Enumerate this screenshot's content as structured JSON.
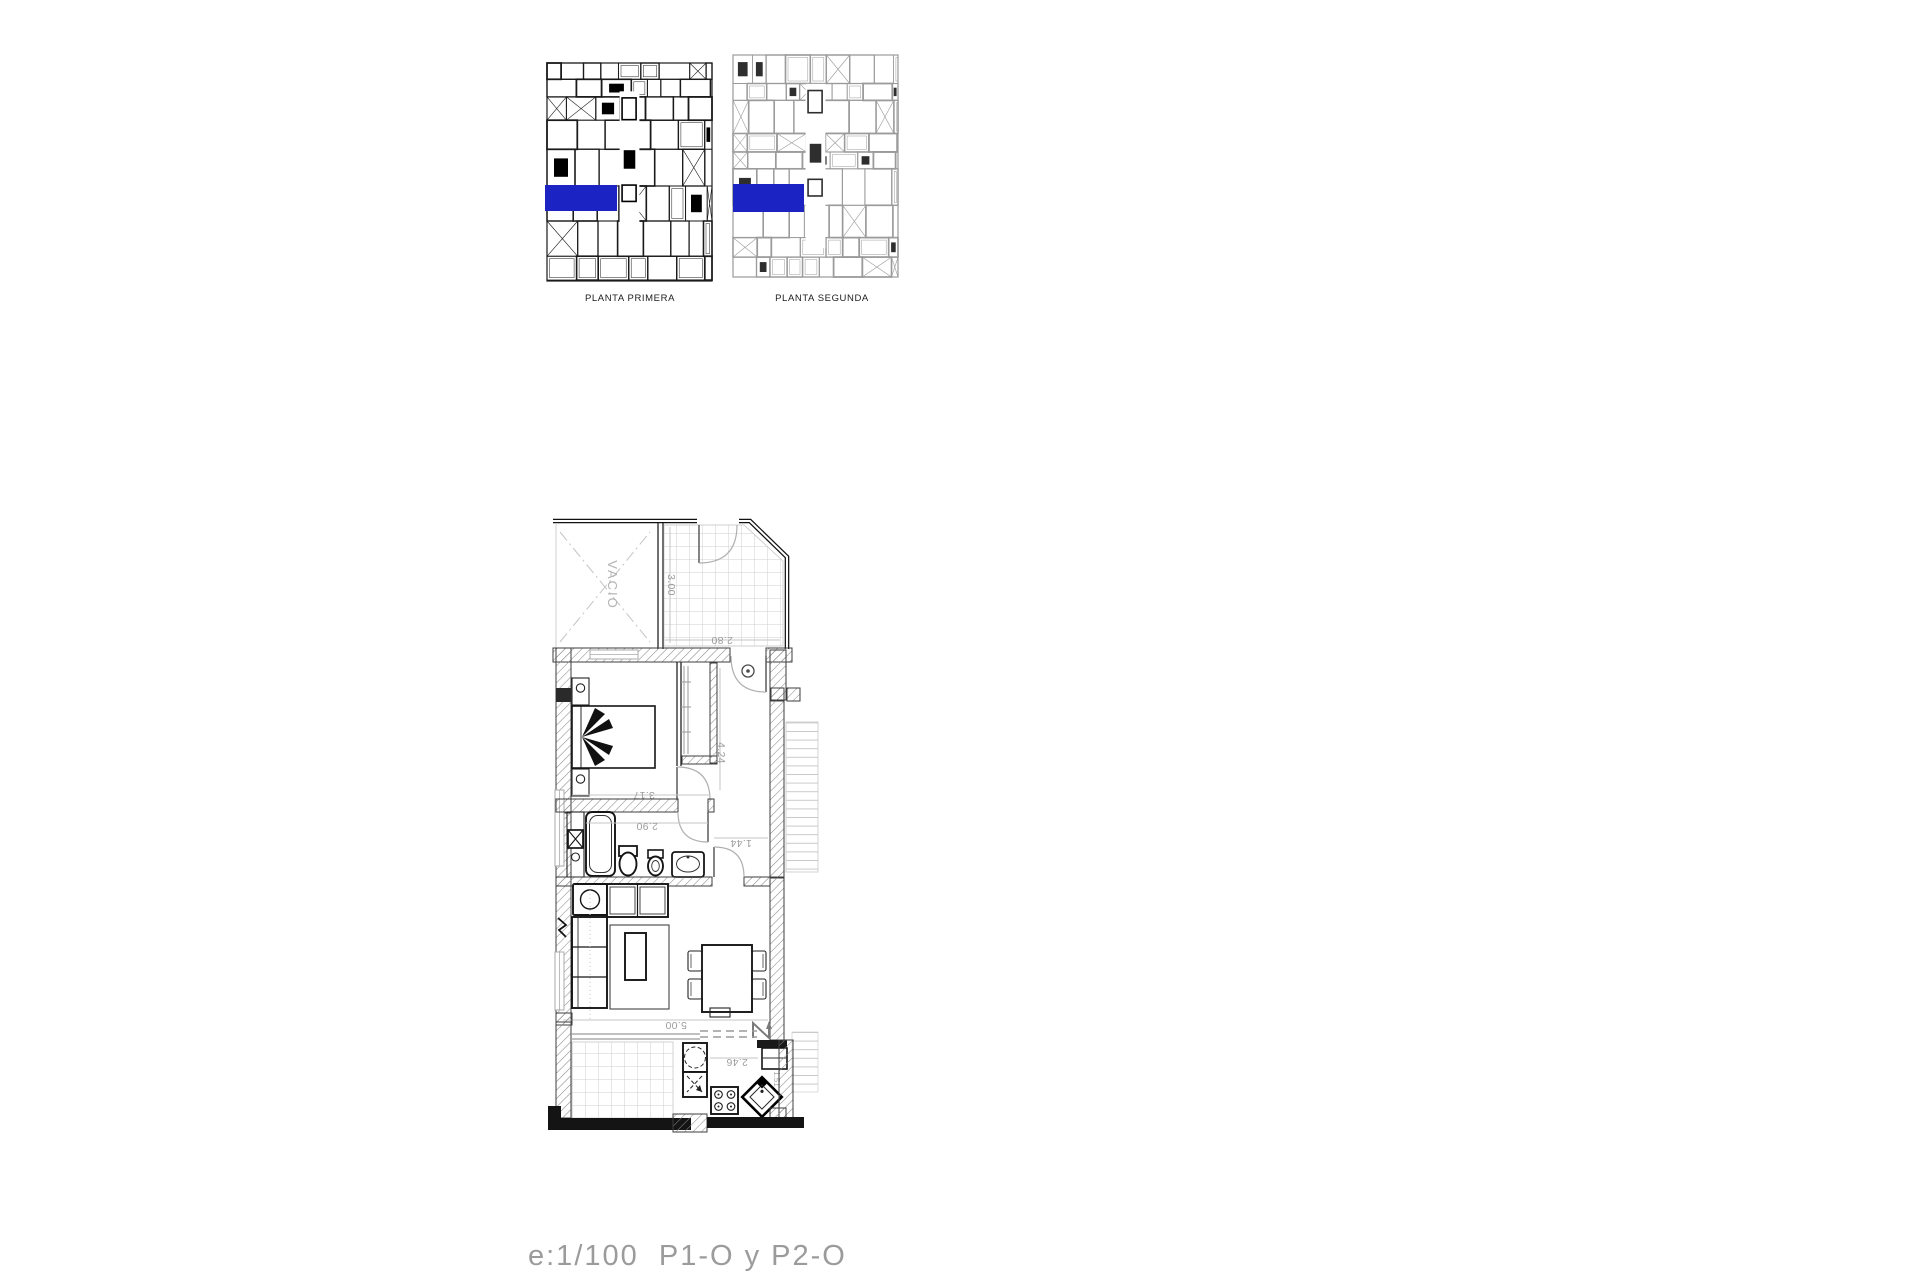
{
  "overview": {
    "plans": [
      {
        "label": "PLANTA PRIMERA"
      },
      {
        "label": "PLANTA SEGUNDA"
      }
    ],
    "highlight_color": "#1b23c3"
  },
  "floor_plan": {
    "void_label": "VACIO",
    "dims": {
      "terrace_depth": "3.00",
      "terrace_width": "2.80",
      "bedroom_width": "3.17",
      "hall_depth": "4.24",
      "bathroom_width": "2.90",
      "corridor_width": "1.44",
      "living_width": "5.00",
      "kitchen_width": "2.46",
      "kitchen_depth": "1.51"
    }
  },
  "footer": {
    "scale_label": "e:1/100  P1-O y P2-O"
  }
}
